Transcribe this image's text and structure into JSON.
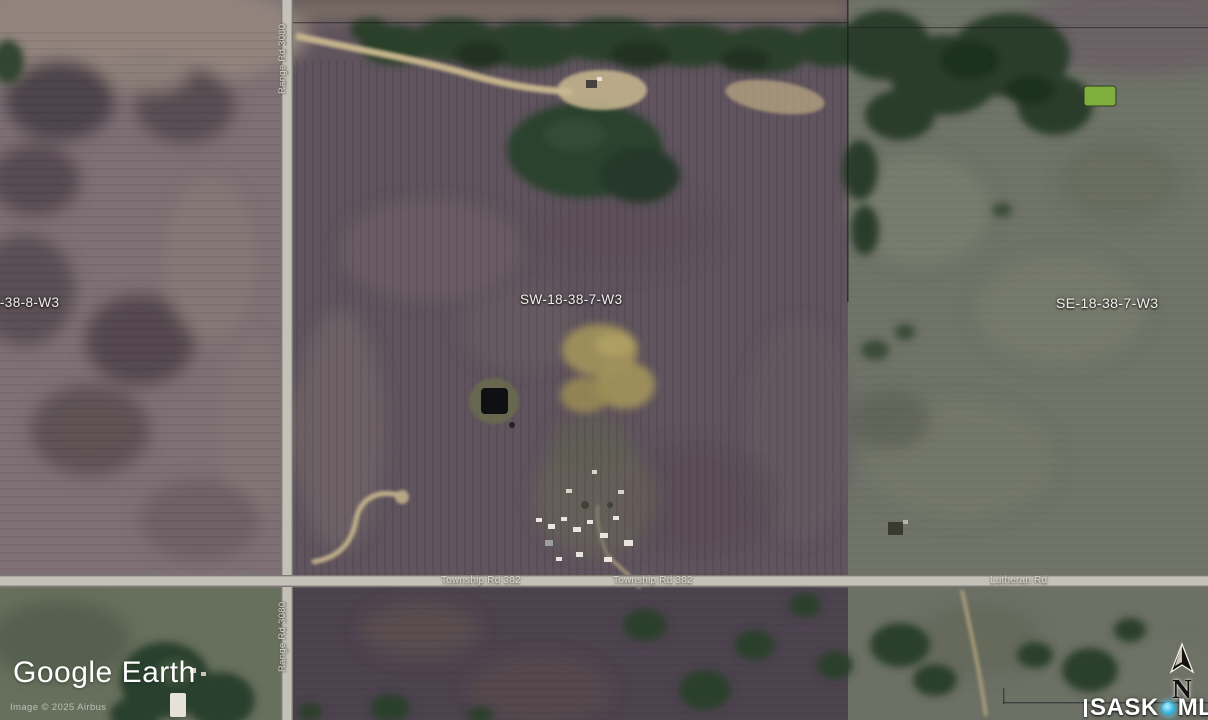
{
  "map": {
    "parcel_labels": {
      "west": "8-38-8-W3",
      "subject": "SW-18-38-7-W3",
      "east": "SE-18-38-7-W3"
    },
    "road_labels": {
      "range_rd_top": "Range Rd 3080",
      "range_rd_bottom": "Range Rd 3080",
      "township_rd_west": "Township Rd 382",
      "township_rd_east": "Township Rd 382",
      "lutheran_rd": "Lutheran Rd"
    }
  },
  "watermarks": {
    "google_earth": "Google Earth",
    "imagery_credit": "Image © 2025 Airbus",
    "mls_name_1": "SASK",
    "mls_name_2": "MLS",
    "mls_registered": "®"
  },
  "compass": {
    "north": "N"
  },
  "colors": {
    "boundary_red": "#e81111",
    "road_gray": "#c4c1b8",
    "mls_dot_blue": "#49c4ee",
    "pond_green": "#7fae3f"
  }
}
